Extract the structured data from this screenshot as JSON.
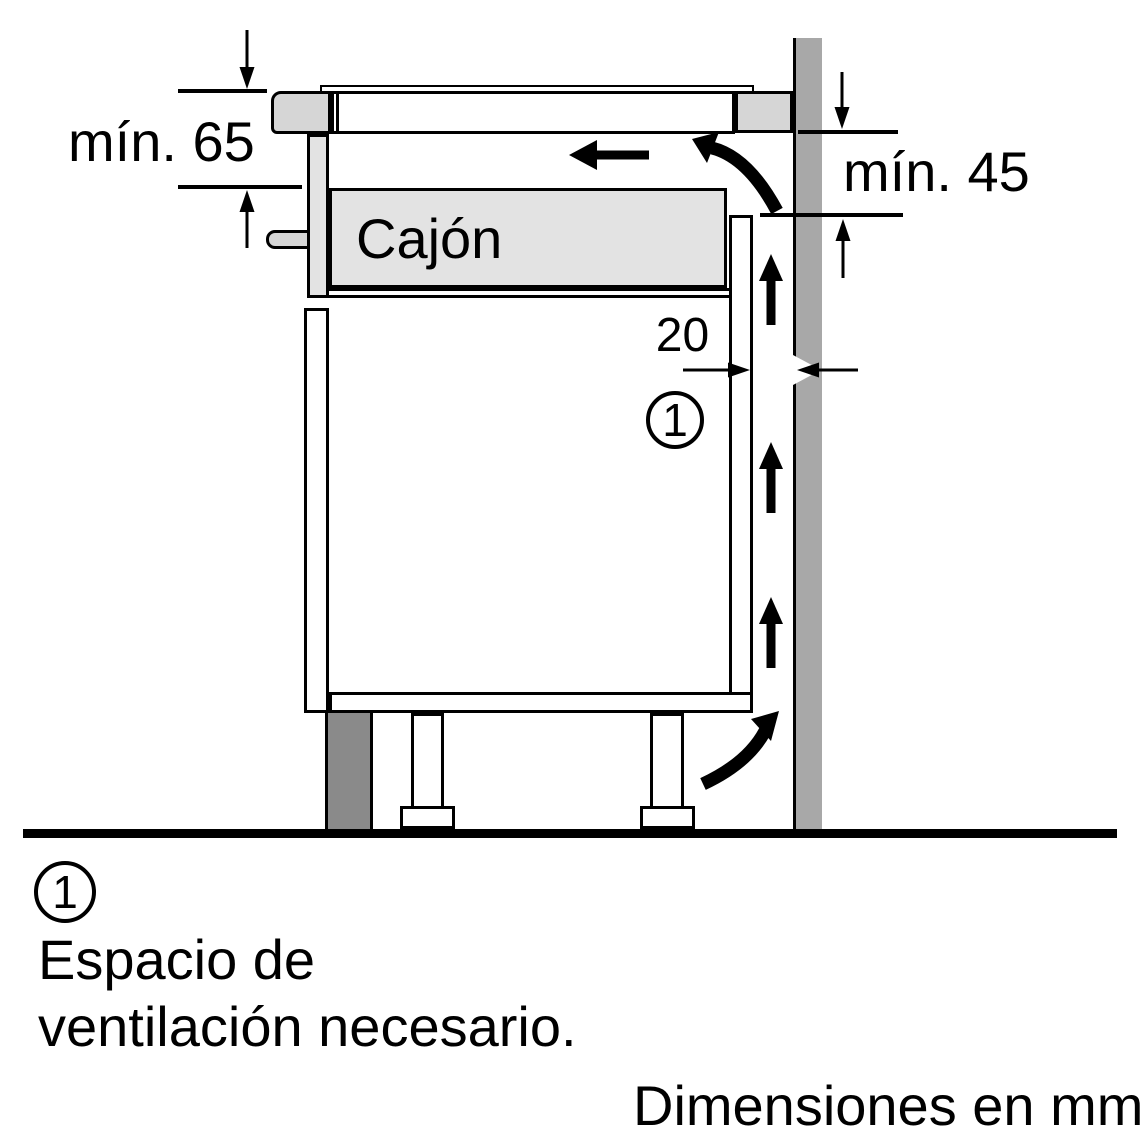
{
  "diagram": {
    "labels": {
      "min_top_clearance": "mín. 65",
      "min_side_clearance": "mín. 45",
      "vent_gap_mm": "20",
      "drawer": "Cajón",
      "vent_marker": "1"
    },
    "colors": {
      "background": "#ffffff",
      "line": "#000000",
      "wall": "#a8a8a8",
      "panel": "#d6d6d6",
      "drawer": "#e3e3e3",
      "plinth": "#8a8a8a"
    }
  },
  "legend": {
    "marker": "1",
    "text_line1": "Espacio de",
    "text_line2": "ventilación necesario."
  },
  "footer": {
    "units_note": "Dimensiones en mm"
  }
}
